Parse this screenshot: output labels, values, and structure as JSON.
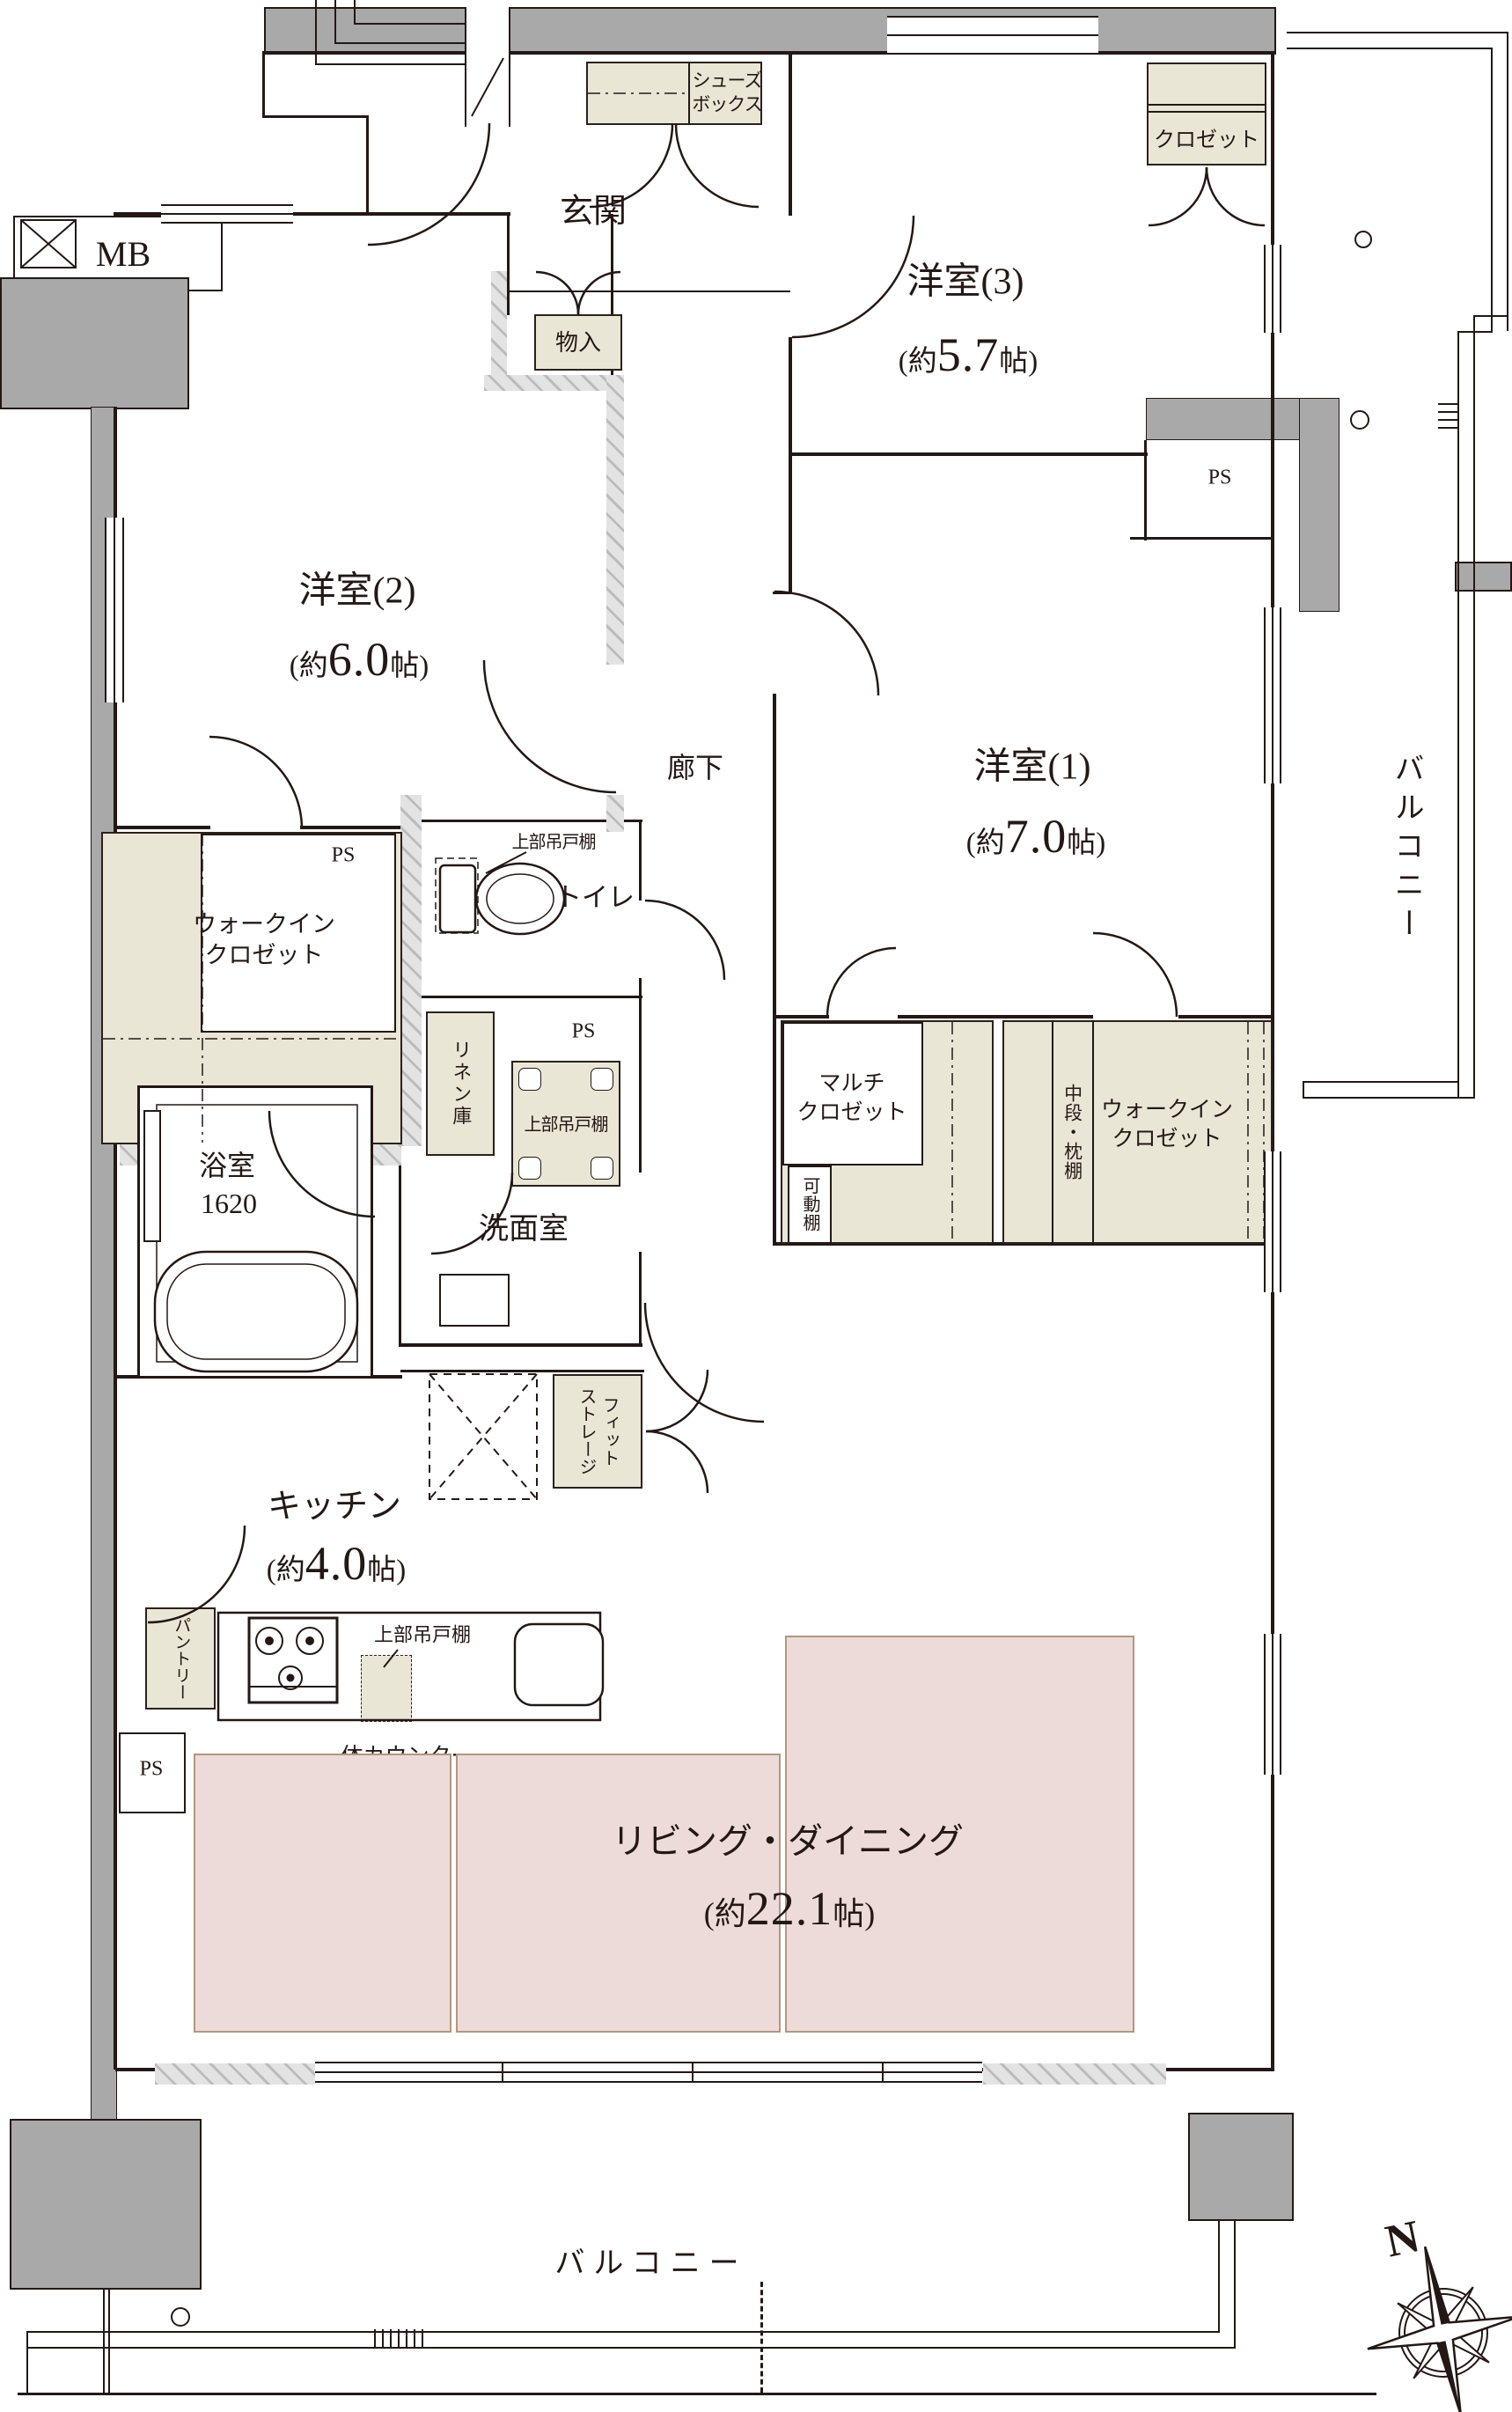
{
  "labels": {
    "mb": "MB",
    "genkan": "玄関",
    "shoes": "シューズ\nボックス",
    "mono": "物入",
    "closet": "クロゼット",
    "yo3": "洋室(3)",
    "yo2": "洋室(2)",
    "yo1": "洋室(1)",
    "ps": "PS",
    "rouka": "廊下",
    "wic": "ウォークイン\nクロゼット",
    "toilet": "トイレ",
    "upper_shelf": "上部吊戸棚",
    "linen": "リネン庫",
    "senmen": "洗面室",
    "bath": "浴室",
    "bath_size": "1620",
    "multi": "マルチ\nクロゼット",
    "kadou": "可動棚",
    "chudan": "中段・枕棚",
    "kitchen": "キッチン",
    "fit": "フィット\nストレージ",
    "pantry": "パントリー",
    "counter": "一体カウンター",
    "ld": "リビング・ダイニング",
    "balcony": "バルコニー",
    "north": "N"
  },
  "sizes": {
    "yo3": {
      "pre": "(約",
      "num": "5.7",
      "post": "帖)"
    },
    "yo2": {
      "pre": "(約",
      "num": "6.0",
      "post": "帖)"
    },
    "yo1": {
      "pre": "(約",
      "num": "7.0",
      "post": "帖)"
    },
    "kitchen": {
      "pre": "(約",
      "num": "4.0",
      "post": "帖)"
    },
    "ld": {
      "pre": "(約",
      "num": "22.1",
      "post": "帖)"
    }
  },
  "colors": {
    "line": "#231815",
    "structure_gray": "#a9a9a9",
    "storage_beige": "#eae6d6",
    "ld_pink": "#eddbd9",
    "ld_pink_border": "#b29781"
  }
}
